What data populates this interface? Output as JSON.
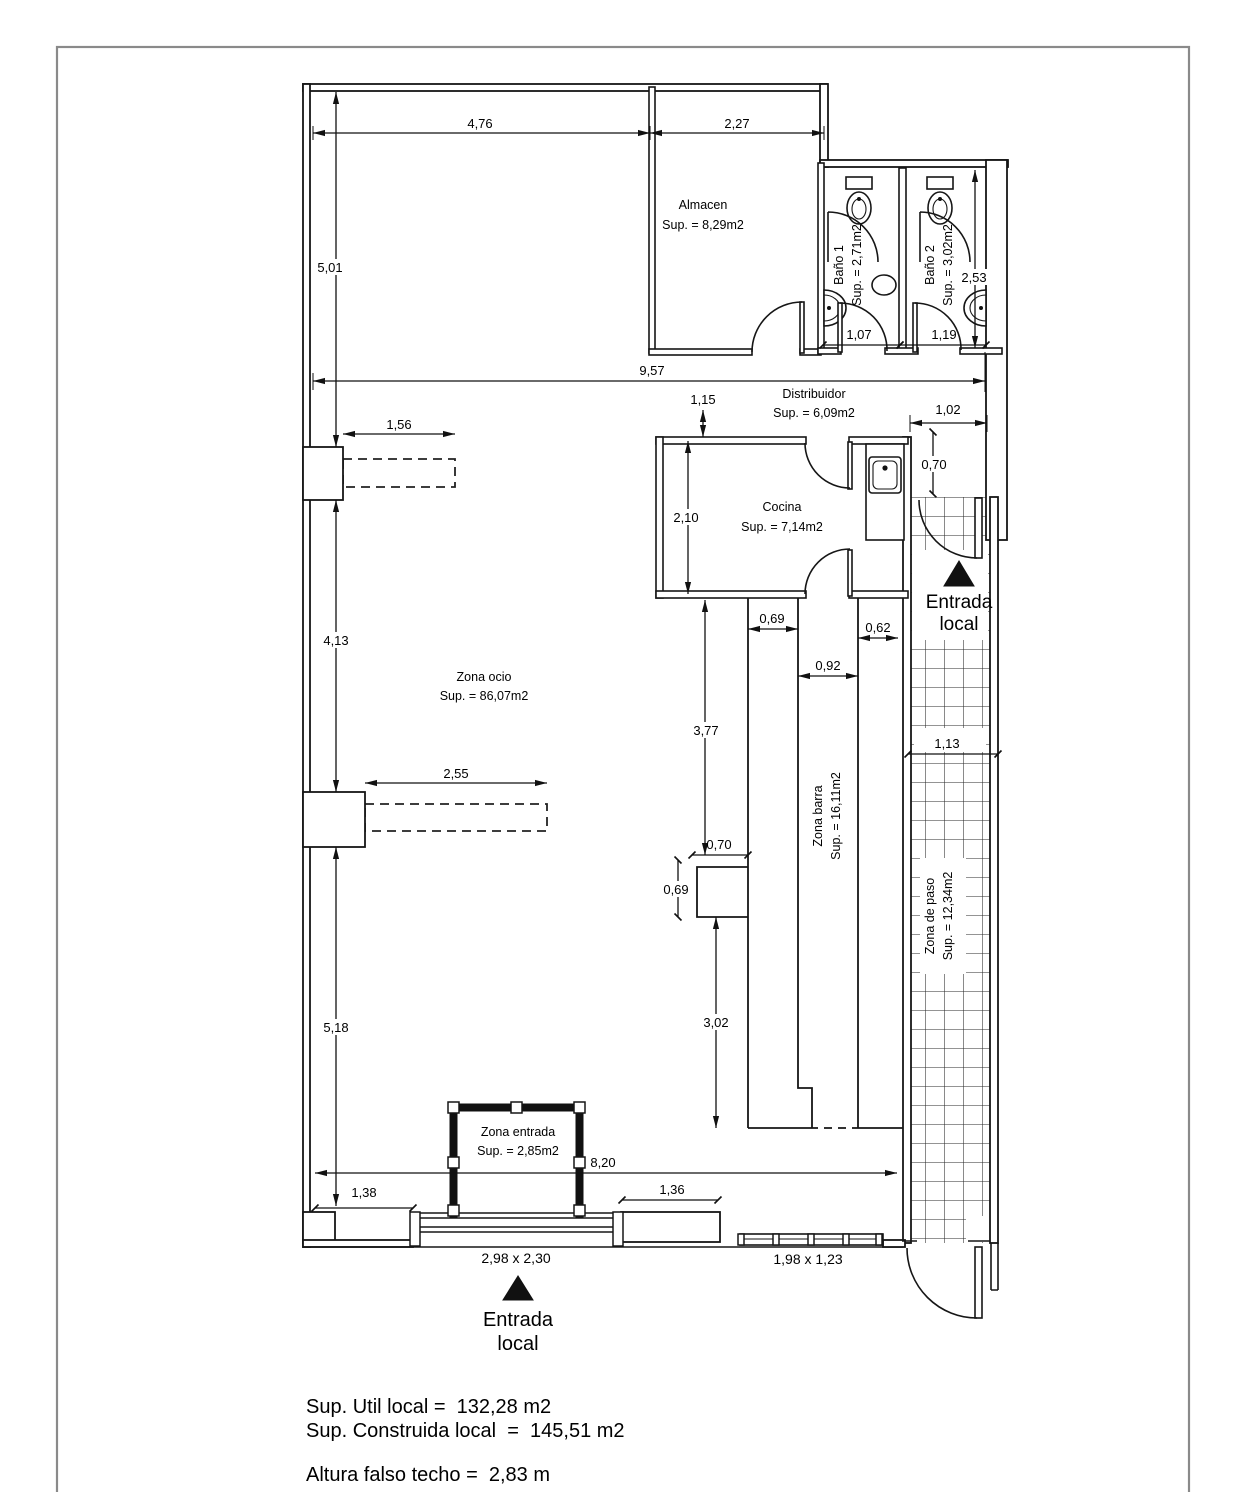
{
  "rooms": {
    "almacen": {
      "name": "Almacen",
      "sup": "Sup. = 8,29m2"
    },
    "bano1": {
      "name": "Baño 1",
      "sup": "Sup. = 2,71m2"
    },
    "bano2": {
      "name": "Baño 2",
      "sup": "Sup. = 3,02m2"
    },
    "distribuidor": {
      "name": "Distribuidor",
      "sup": "Sup. = 6,09m2"
    },
    "cocina": {
      "name": "Cocina",
      "sup": "Sup. = 7,14m2"
    },
    "zona_ocio": {
      "name": "Zona ocio",
      "sup": "Sup. = 86,07m2"
    },
    "zona_barra": {
      "name": "Zona barra",
      "sup": "Sup. = 16,11m2"
    },
    "zona_paso": {
      "name": "Zona de paso",
      "sup": "Sup. = 12,34m2"
    },
    "zona_entrada": {
      "name": "Zona entrada",
      "sup": "Sup. = 2,85m2"
    }
  },
  "entrances": {
    "right": {
      "line1": "Entrada",
      "line2": "local"
    },
    "bottom": {
      "line1": "Entrada",
      "line2": "local"
    }
  },
  "dims": {
    "top_left": "4,76",
    "top_right": "2,27",
    "left_upper": "5,01",
    "left_middle": "4,13",
    "left_lower": "5,18",
    "interior_width": "9,57",
    "distribuidor_depth": "1,15",
    "bath1_width": "1,07",
    "bath2_width": "1,19",
    "bath_depth": "2,53",
    "passage_width": "1,02",
    "passage_door": "0,70",
    "recess1": "1,56",
    "recess2": "2,55",
    "cocina_depth": "2,10",
    "bar_top_gap": "0,69",
    "counter_width": "0,62",
    "bar_aisle": "0,92",
    "bar_upper_len": "3,77",
    "bar_step_w": "0,70",
    "bar_step_h": "0,69",
    "bar_lower_len": "3,02",
    "corridor_width": "1,13",
    "bottom_span": "8,20",
    "bottom_left": "1,38",
    "bottom_right": "1,36"
  },
  "openings": {
    "storefront": "2,98 x 2,30",
    "window": "1,98 x 1,23"
  },
  "summary": {
    "util": "Sup. Util local =  132,28 m2",
    "construida": "Sup. Construida local  =  145,51 m2",
    "altura": "Altura falso techo =  2,83 m"
  }
}
